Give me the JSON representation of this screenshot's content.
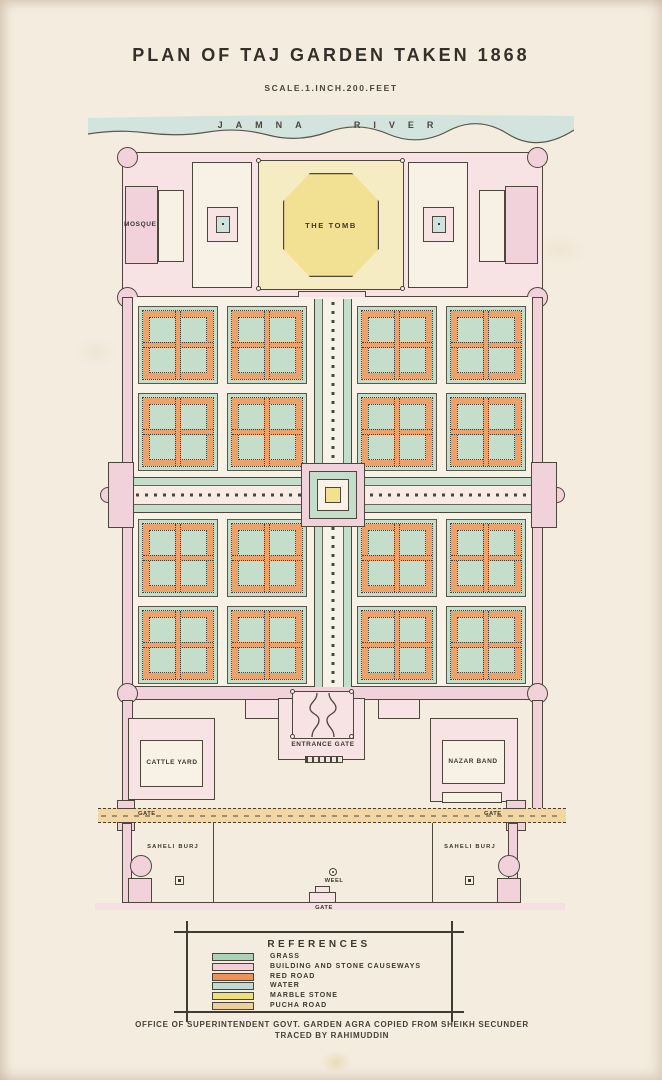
{
  "colors": {
    "ink": "#3e3a30",
    "line": "#4c463b",
    "grass": "#c5decb",
    "building_pink": "#f7e3e4",
    "wall_pink": "#f2d2da",
    "red_road": "#eea26b",
    "water": "#cfe3de",
    "marble": "#f6ecc3",
    "marble_deep": "#f3e193",
    "pucha": "#f2d6a3"
  },
  "title": "PLAN OF TAJ GARDEN TAKEN 1868",
  "scale_note": "SCALE.1.INCH.200.FEET",
  "river": {
    "label": "JAMNA RIVER"
  },
  "plan": {
    "mosque": "MOSQUE",
    "tomb": "THE TOMB",
    "entrance_gate": "ENTRANCE GATE",
    "cattle_yard": "CATTLE YARD",
    "nazar_band": "NAZAR BAND",
    "gate_left": "GATE",
    "gate_right": "GATE",
    "gate_bottom": "GATE",
    "saheli_burj_left": "SAHELI BURJ",
    "saheli_burj_right": "SAHELI BURJ",
    "well": "WEEL"
  },
  "legend": {
    "title": "REFERENCES",
    "items": [
      {
        "label": "GRASS",
        "color": "#aad2b9"
      },
      {
        "label": "BUILDING AND STONE CAUSEWAYS",
        "color": "#f2ced8"
      },
      {
        "label": "RED ROAD",
        "color": "#eb9259"
      },
      {
        "label": "WATER",
        "color": "#c2dad4"
      },
      {
        "label": "MARBLE STONE",
        "color": "#efe07c"
      },
      {
        "label": "PUCHA ROAD",
        "color": "#eecf9b"
      }
    ]
  },
  "footer": {
    "line1": "OFFICE OF SUPERINTENDENT GOVT. GARDEN AGRA  COPIED FROM SHEIKH SECUNDER",
    "line2": "TRACED BY RAHIMUDDIN"
  }
}
